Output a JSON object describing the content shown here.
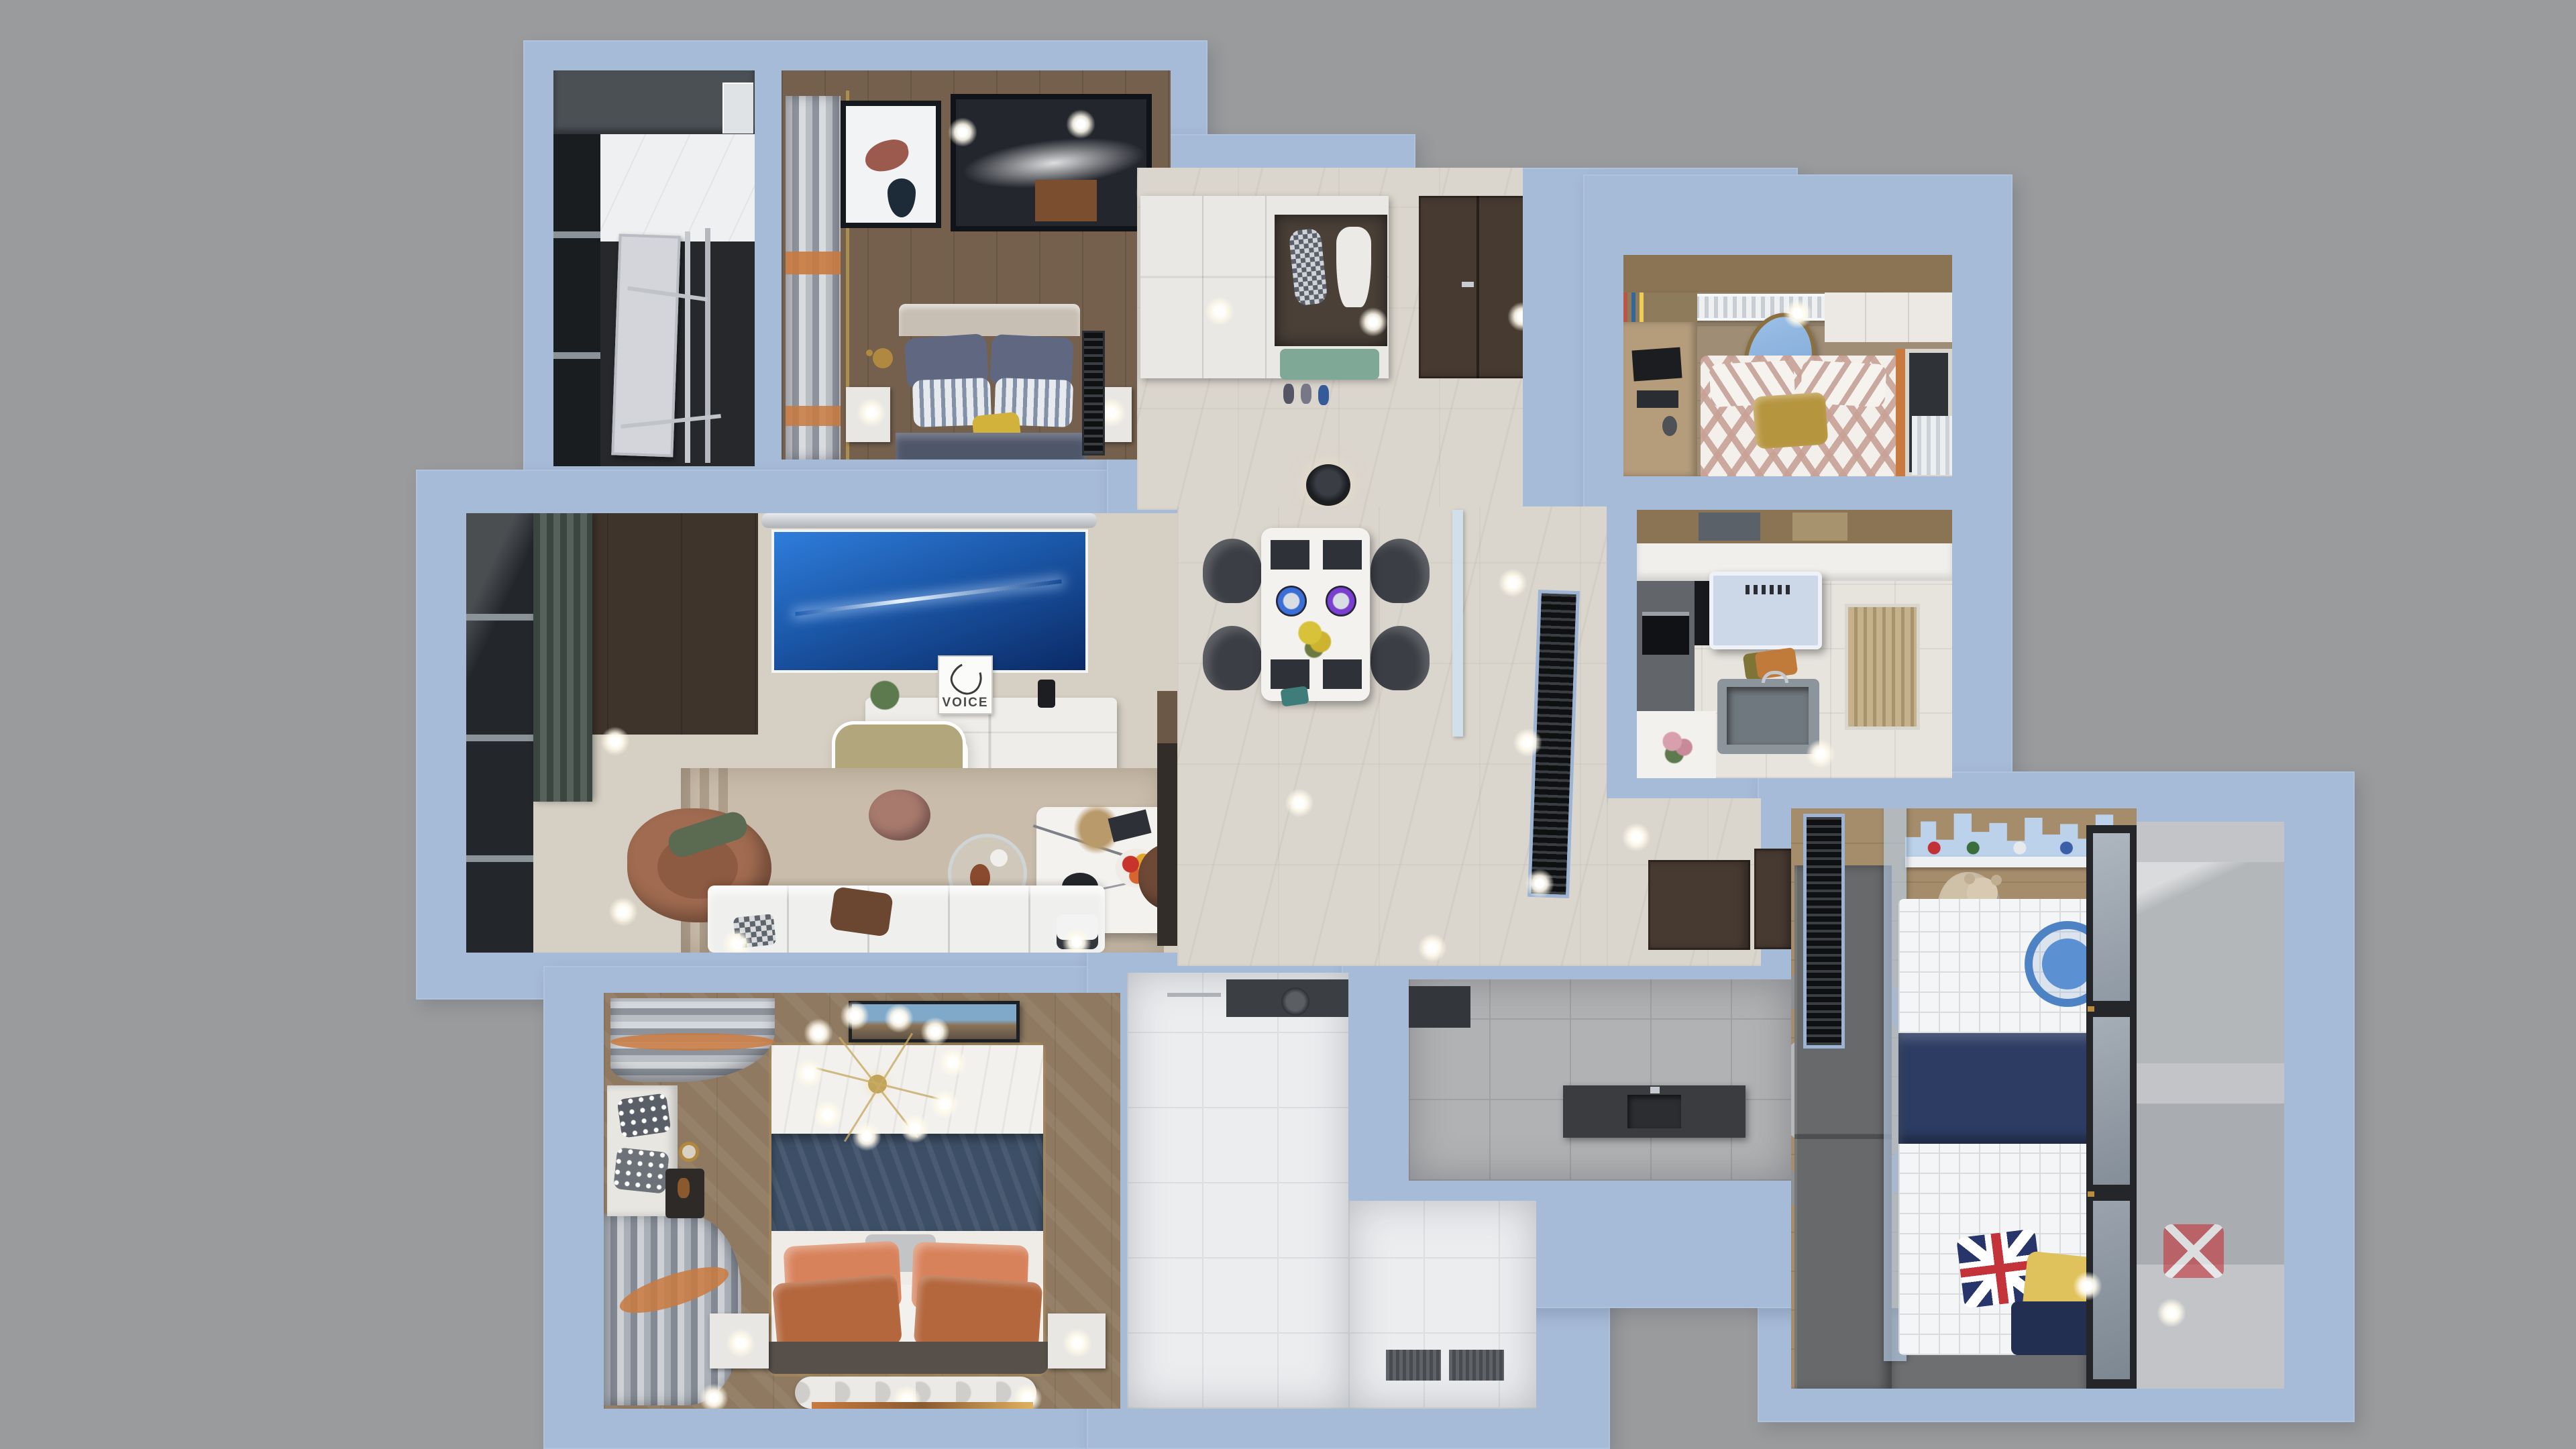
{
  "scene": {
    "description": "Top-down 3D architectural render of a furnished apartment floor plan on a gray backdrop",
    "view": "orthographic top-down dollhouse render"
  },
  "labels": {
    "tv_card": "VOICE"
  },
  "colors": {
    "bg": "#9a9b9c",
    "wall": "#a6bbd8",
    "wallEdge": "#c3d2e8",
    "hallFloor": "#dad5cd",
    "livingFloor": "#d6cfc3",
    "rug": "#c9bcaa",
    "woodBed2": "#74604d",
    "woodMaster": "#8f7a61",
    "woodKids": "#a58d6c",
    "woodBed3": "#9f8d75",
    "woodDesk": "#b59d7c",
    "kitchenFloor": "#e7e4de",
    "bathWhite": "#ecedef",
    "bathWhiteLine": "#dcdee1",
    "bathGray": "#b1b2b4",
    "bathGrayLine": "#a0a1a3",
    "laundryFloor": "#26282c",
    "balconyFloor": "#c2c4c7",
    "doorBrown": "#473a31",
    "closetDark": "#332d29",
    "screenBlueTop": "#2f7ddb",
    "screenBlueDeep": "#0b2a66",
    "consoleWhite": "#efede9",
    "lampGold": "#b2a67c",
    "curtainGreen": "#47524c",
    "sofaCream": "#eff0ee",
    "armchairRust": "#a06b50",
    "poufRose": "#a87a6e",
    "leatherBrown": "#6d4936",
    "navyBlanket": "#4e5669",
    "pillowNavy": "#5f6880",
    "pillowYellow": "#d3b23c",
    "headboardGray": "#c7bfb4",
    "benchGreen": "#7fa896",
    "tableMarble": "#f4f2ef",
    "chairDark": "#3b3e44",
    "flowerYellow": "#d8c23a",
    "masterNavy": "#3d4f66",
    "pillowSalmon": "#d8825b",
    "pillowRust": "#b4663c",
    "masterHeadboard": "#57504a",
    "chevronRose": "#c8a195",
    "pillowGold": "#b6953f",
    "mirrorBlue": "#9cc0e8",
    "hoodBlue": "#ccd7e8",
    "tealPot": "#2f8f86",
    "blindsBeige": "#c5b28c",
    "counterGray": "#62656a",
    "kidsNavy": "#2c3c63",
    "unionRed": "#c5333a",
    "unionBlue": "#27356b",
    "kidsYellow": "#e0c25c",
    "kidsTableBlue": "#4d82c4",
    "skylineBlue": "#bcd2ea",
    "wardrobeGray": "#68696b",
    "teddy": "#cfc0a8",
    "vanityDark": "#3a3c3f",
    "cabinetTopWood": "#8a7454",
    "orangeCurtain": "#c97a3e",
    "rackSilver": "#d3d5da"
  },
  "rooms": [
    {
      "id": "laundry-room"
    },
    {
      "id": "second-bedroom"
    },
    {
      "id": "living-room"
    },
    {
      "id": "entry-hall"
    },
    {
      "id": "dining-area"
    },
    {
      "id": "corridor"
    },
    {
      "id": "third-bedroom"
    },
    {
      "id": "kitchen"
    },
    {
      "id": "kids-bedroom"
    },
    {
      "id": "kids-balcony"
    },
    {
      "id": "main-bathroom"
    },
    {
      "id": "gray-bathroom"
    },
    {
      "id": "utility-closet"
    },
    {
      "id": "master-bedroom"
    }
  ]
}
